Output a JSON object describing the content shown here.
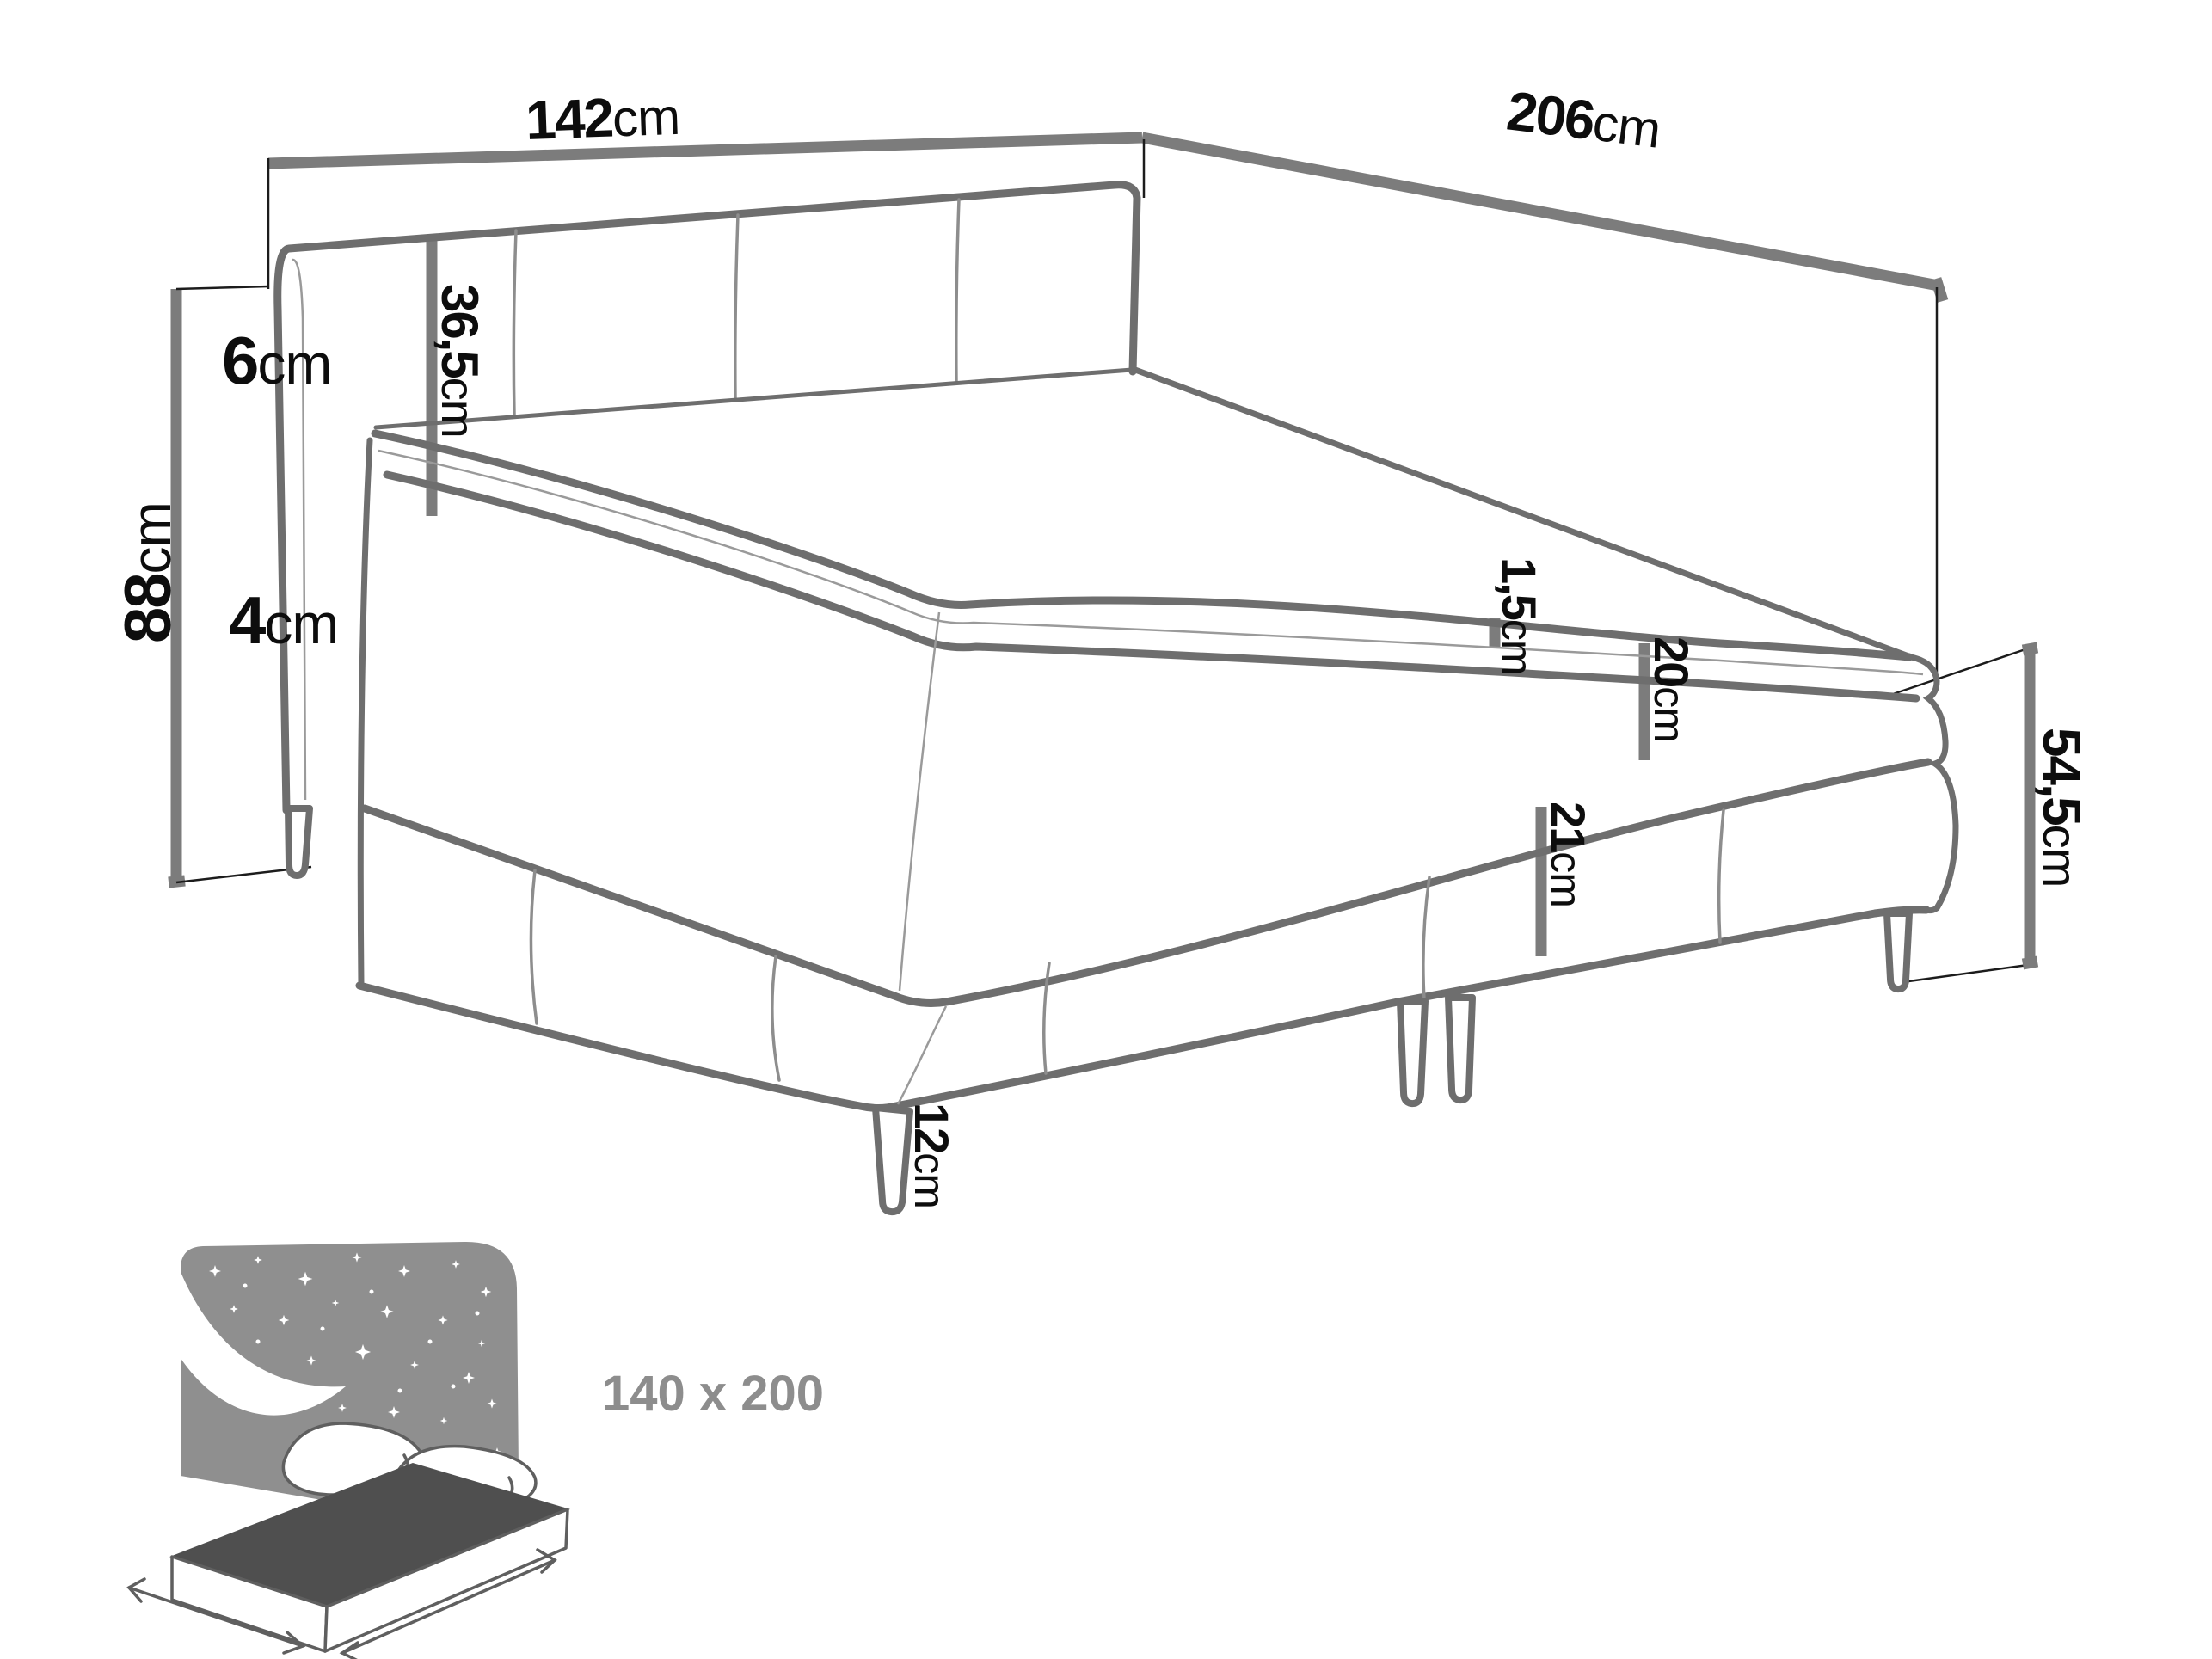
{
  "figure": {
    "kind": "bed dimension diagram",
    "unit": "cm"
  },
  "dimensions": {
    "headboard_wall_width": {
      "value": "142",
      "unit": "cm"
    },
    "side_wall_length": {
      "value": "206",
      "unit": "cm"
    },
    "headboard_thickness": {
      "value": "6",
      "unit": "cm"
    },
    "headboard_above_mattress": {
      "value": "36,5",
      "unit": "cm"
    },
    "total_height": {
      "value": "88",
      "unit": "cm"
    },
    "topper_height": {
      "value": "4",
      "unit": "cm"
    },
    "topper_seam": {
      "value": "1,5",
      "unit": "cm"
    },
    "mattress_height": {
      "value": "20",
      "unit": "cm"
    },
    "base_height": {
      "value": "21",
      "unit": "cm"
    },
    "bed_side_height": {
      "value": "54,5",
      "unit": "cm"
    },
    "leg_height": {
      "value": "12",
      "unit": "cm"
    }
  },
  "badge": {
    "size_label": "140 x 200"
  },
  "colors": {
    "wall_line": "#7c7c7c",
    "bed_line": "#6e6e6e",
    "extension_line": "#1c1c1c",
    "label_text": "#0d0d0d",
    "badge_text": "#8d8d8d",
    "icon_panel": "#8f8f8f",
    "icon_mattress_top": "#4f4f4f"
  }
}
